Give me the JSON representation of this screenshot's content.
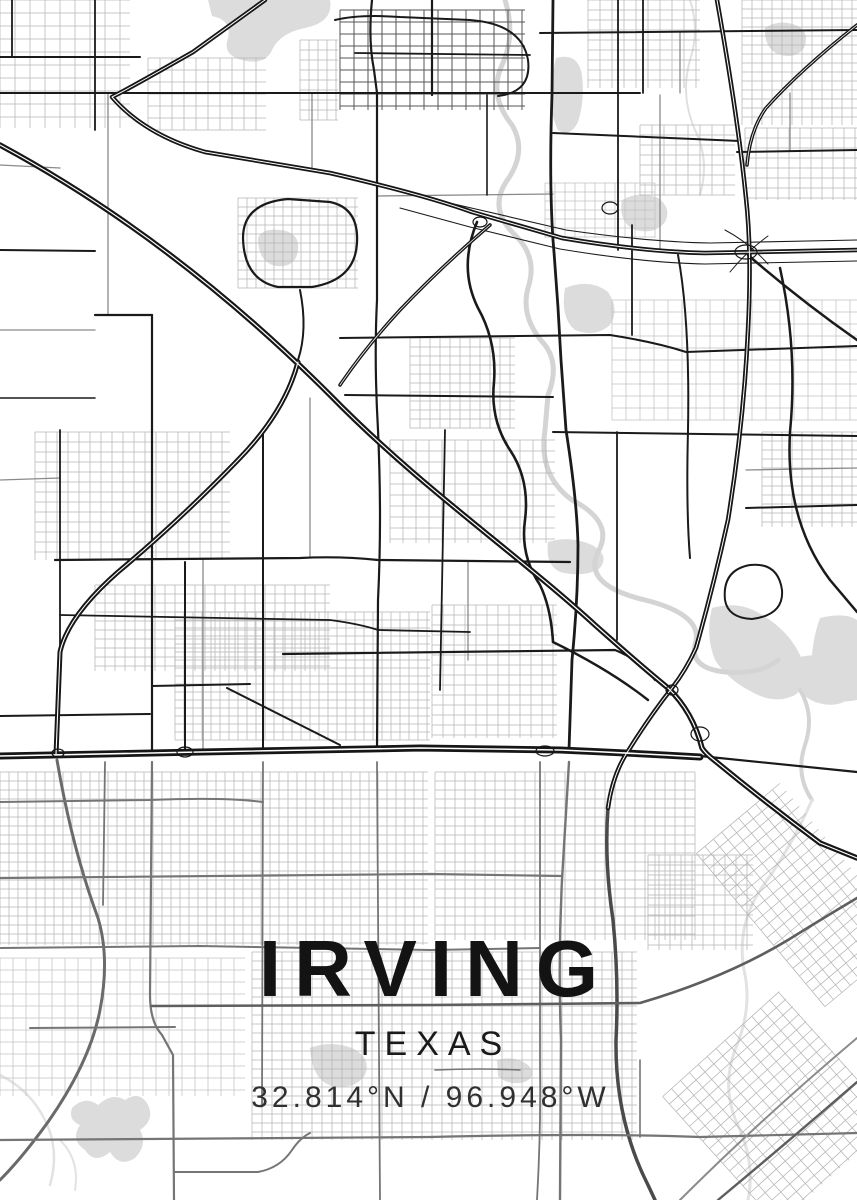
{
  "poster": {
    "city": "IRVING",
    "state": "TEXAS",
    "coordinates": "32.814°N / 96.948°W",
    "colors": {
      "background": "#ffffff",
      "title": "#131313",
      "subtitle": "#1a1a1a",
      "coords": "#303030",
      "road_major": "#1a1a1a",
      "road_medium": "#8a8a8a",
      "road_minor": "#b5b5b5",
      "road_gray": "#757575",
      "freeway": "#161616",
      "freeway_core": "#ffffff",
      "water": "#dcdcdc",
      "river": "#d4d4d4"
    },
    "map": {
      "water": [
        {
          "d": "M208,0 L330,0 Q334,22 305,28 Q280,33 272,50 Q265,66 242,60 Q222,55 228,38 Q232,20 212,16 Z"
        },
        {
          "d": "M765,28 Q780,18 798,26 Q810,34 804,48 Q795,60 778,54 Q764,48 765,28 Z"
        },
        {
          "d": "M556,58 Q578,52 582,75 Q585,100 578,122 Q570,138 558,130 Q548,110 552,85 Q553,70 556,58 Z"
        },
        {
          "d": "M622,200 Q640,190 658,198 Q672,208 665,222 Q655,235 635,230 Q618,222 622,200 Z"
        },
        {
          "d": "M258,238 Q262,228 280,230 Q300,232 298,250 Q296,268 276,266 Q258,262 258,238 Z"
        },
        {
          "d": "M565,288 Q590,278 608,292 Q620,310 610,325 Q595,338 575,330 Q560,318 565,288 Z"
        },
        {
          "d": "M548,542 Q570,535 592,545 Q610,555 600,568 Q585,578 560,572 Q545,565 548,542 Z"
        },
        {
          "d": "M712,608 Q740,600 762,615 Q788,630 800,655 Q812,682 795,695 Q775,705 752,692 Q728,680 715,660 Q705,635 712,608 Z"
        },
        {
          "d": "M795,658 Q825,650 845,665 Q860,680 852,695 Q840,710 815,702 Q798,695 795,678 Z"
        },
        {
          "d": "M820,618 Q845,612 857,620 L857,700 Q835,705 818,692 Q805,660 820,618 Z"
        },
        {
          "d": "M310,1048 Q330,1040 352,1048 Q372,1058 365,1075 Q355,1090 332,1086 Q312,1080 310,1048 Z"
        },
        {
          "d": "M497,1060 Q515,1055 528,1065 Q538,1075 525,1082 Q508,1086 498,1076 Z"
        },
        {
          "d": "M72,1108 Q85,1095 98,1105 Q112,1092 125,1100 Q140,1090 148,1105 Q155,1120 140,1130 Q148,1145 135,1158 Q120,1168 110,1152 Q95,1165 85,1150 Q70,1140 80,1125 Q68,1120 72,1108 Z"
        }
      ],
      "rivers": [
        {
          "d": "M505,0 Q516,35 502,65 Q488,95 512,125 Q528,152 506,182 Q488,210 516,236 Q538,258 528,288 Q520,318 545,345 Q560,365 548,395 L545,430",
          "w": 5
        },
        {
          "d": "M545,430 Q538,475 572,500 Q615,522 598,552 Q582,585 645,600 Q705,615 695,645 Q690,668 725,672 Q760,675 778,660",
          "w": 5
        },
        {
          "d": "M800,690 Q815,715 805,745 Q795,775 812,800",
          "w": 4
        },
        {
          "d": "M812,800 Q790,850 760,890 Q735,930 745,975 Q752,1010 735,1050 Q720,1090 740,1130 Q755,1165 748,1200",
          "w": 3,
          "c": "#e2e2e2"
        },
        {
          "d": "M690,0 Q700,30 690,60 Q680,95 695,130 Q710,160 700,195",
          "w": 2,
          "c": "#e0e0e0"
        },
        {
          "d": "M0,1075 Q30,1090 45,1120 Q60,1150 50,1185",
          "w": 2.5,
          "c": "#e2e2e2"
        },
        {
          "d": "M60,1140 Q80,1160 75,1190",
          "w": 2,
          "c": "#e2e2e2"
        }
      ],
      "grids": [
        {
          "x": 0,
          "y": 0,
          "w": 130,
          "h": 128,
          "gx": 15,
          "gy": 13
        },
        {
          "x": 148,
          "y": 58,
          "w": 118,
          "h": 72,
          "gx": 12,
          "gy": 12
        },
        {
          "x": 300,
          "y": 40,
          "w": 38,
          "h": 80,
          "gx": 9,
          "gy": 10
        },
        {
          "x": 340,
          "y": 10,
          "w": 185,
          "h": 100,
          "gx": 14,
          "gy": 12,
          "c": "#555555",
          "lw": 1
        },
        {
          "x": 588,
          "y": 0,
          "w": 112,
          "h": 88,
          "gx": 12,
          "gy": 10
        },
        {
          "x": 742,
          "y": 0,
          "w": 115,
          "h": 125,
          "gx": 10,
          "gy": 9
        },
        {
          "x": 745,
          "y": 128,
          "w": 112,
          "h": 72,
          "gx": 11,
          "gy": 10
        },
        {
          "x": 640,
          "y": 125,
          "w": 95,
          "h": 70,
          "gx": 12,
          "gy": 10
        },
        {
          "x": 545,
          "y": 183,
          "w": 110,
          "h": 55,
          "gx": 10,
          "gy": 9,
          "c": "#c0c0c0"
        },
        {
          "x": 238,
          "y": 198,
          "w": 120,
          "h": 90,
          "gx": 9,
          "gy": 9
        },
        {
          "x": 612,
          "y": 300,
          "w": 245,
          "h": 120,
          "gx": 14,
          "gy": 12,
          "c": "#c0c0c0"
        },
        {
          "x": 410,
          "y": 338,
          "w": 105,
          "h": 90,
          "gx": 10,
          "gy": 9
        },
        {
          "x": 35,
          "y": 432,
          "w": 195,
          "h": 128,
          "gx": 11,
          "gy": 10
        },
        {
          "x": 95,
          "y": 585,
          "w": 235,
          "h": 86,
          "gx": 10,
          "gy": 9
        },
        {
          "x": 175,
          "y": 612,
          "w": 255,
          "h": 128,
          "gx": 9,
          "gy": 8
        },
        {
          "x": 390,
          "y": 440,
          "w": 165,
          "h": 103,
          "gx": 13,
          "gy": 11
        },
        {
          "x": 432,
          "y": 605,
          "w": 125,
          "h": 133,
          "gx": 11,
          "gy": 10
        },
        {
          "x": 762,
          "y": 432,
          "w": 95,
          "h": 95,
          "gx": 10,
          "gy": 9
        },
        {
          "x": 0,
          "y": 772,
          "w": 428,
          "h": 173,
          "gx": 9,
          "gy": 9
        },
        {
          "x": 435,
          "y": 772,
          "w": 260,
          "h": 168,
          "gx": 10,
          "gy": 9
        },
        {
          "x": 0,
          "y": 958,
          "w": 245,
          "h": 138,
          "gx": 13,
          "gy": 12,
          "c": "#c2c2c2"
        },
        {
          "x": 252,
          "y": 952,
          "w": 385,
          "h": 188,
          "gx": 10,
          "gy": 9
        },
        {
          "x": 648,
          "y": 855,
          "w": 105,
          "h": 95,
          "gx": 11,
          "gy": 10
        },
        {
          "x": 700,
          "y": 1022,
          "w": 157,
          "h": 172,
          "gx": 12,
          "gy": 10,
          "rot": -42
        },
        {
          "x": 748,
          "y": 795,
          "w": 109,
          "h": 200,
          "gx": 11,
          "gy": 10,
          "rot": -40
        }
      ],
      "mediums": [
        {
          "d": "M108,93 L108,315"
        },
        {
          "d": "M310,398 L310,558"
        },
        {
          "d": "M312,93 L312,170"
        },
        {
          "d": "M660,95 L660,250"
        },
        {
          "d": "M0,330 L95,330"
        },
        {
          "d": "M377,196 L553,194"
        },
        {
          "d": "M746,470 L857,468"
        },
        {
          "d": "M790,93 L790,150"
        },
        {
          "d": "M680,33 L680,93"
        },
        {
          "d": "M0,165 L60,168"
        },
        {
          "d": "M468,562 L468,660"
        },
        {
          "d": "M203,560 L203,752"
        },
        {
          "d": "M0,480 L60,478"
        }
      ],
      "grays": [
        {
          "d": "M608,808 Q604,860 613,920 Q619,980 616,1040 Q615,1120 648,1185 L655,1200",
          "w": 3.5,
          "c": "#4a4a4a"
        },
        {
          "d": "M57,760 Q72,848 98,918 Q110,958 100,1010 Q90,1062 48,1122 Q22,1158 0,1180",
          "w": 3,
          "c": "#6a6a6a"
        },
        {
          "d": "M569,762 L562,880 Q558,960 561,1040 L560,1200",
          "w": 2.4
        },
        {
          "d": "M540,762 L540,1065 Q541,1130 537,1200",
          "w": 1.8
        },
        {
          "d": "M377,762 L380,1200",
          "w": 1.8
        },
        {
          "d": "M263,762 L262,1105",
          "w": 1.8
        },
        {
          "d": "M152,762 L150,995 Q150,1022 162,1035 L173,1055 L174,1200",
          "w": 2.2
        },
        {
          "d": "M105,762 L103,905",
          "w": 1.8
        },
        {
          "d": "M0,802 L150,800 Q225,797 263,802",
          "w": 2
        },
        {
          "d": "M0,878 L430,874 L562,876",
          "w": 2.2
        },
        {
          "d": "M0,948 L200,946 L430,950 L540,948",
          "w": 2
        },
        {
          "d": "M152,1006 L430,1005 L640,1003 Q725,978 788,940 Q825,917 857,898",
          "w": 2.6,
          "c": "#5e5e5e"
        },
        {
          "d": "M30,1028 L175,1027",
          "w": 2
        },
        {
          "d": "M0,1140 L430,1137 Q600,1133 700,1137 L857,1133",
          "w": 2.2
        },
        {
          "d": "M174,1172 L258,1172 Q280,1168 292,1150 Q300,1138 310,1133",
          "w": 2
        },
        {
          "d": "M680,1200 Q760,1120 857,1038",
          "w": 2,
          "c": "#8a8a8a"
        },
        {
          "d": "M718,1200 Q790,1140 857,1082",
          "w": 2.4,
          "c": "#5e5e5e"
        },
        {
          "d": "M640,1060 L640,1137",
          "w": 1.6
        },
        {
          "d": "M435,1070 Q480,1068 520,1070",
          "w": 1.6
        }
      ],
      "majors": [
        {
          "d": "M0,93 L640,93",
          "w": 2
        },
        {
          "d": "M540,33 L857,30",
          "w": 2
        },
        {
          "d": "M553,0 L552,95 Q549,180 553,240 Q558,300 561,360 L566,430 Q577,500 578,545 Q578,600 572,660 L569,750",
          "w": 2.8
        },
        {
          "d": "M372,0 Q368,40 374,70 L377,93 L377,300 Q374,360 378,430 Q382,520 378,600 L377,750",
          "w": 2.2
        },
        {
          "d": "M263,430 L263,750",
          "w": 2
        },
        {
          "d": "M152,315 L152,750",
          "w": 2.2
        },
        {
          "d": "M95,315 L152,315",
          "w": 2.2
        },
        {
          "d": "M0,250 L95,251",
          "w": 2
        },
        {
          "d": "M0,57 L140,57",
          "w": 2
        },
        {
          "d": "M12,0 L12,57",
          "w": 1.8
        },
        {
          "d": "M95,0 L95,130",
          "w": 1.8
        },
        {
          "d": "M643,0 L643,93",
          "w": 1.8
        },
        {
          "d": "M618,0 L618,250",
          "w": 1.8
        },
        {
          "d": "M553,133 L740,141",
          "w": 2
        },
        {
          "d": "M737,152 L857,150",
          "w": 2
        },
        {
          "d": "M60,430 L60,650",
          "w": 1.8
        },
        {
          "d": "M0,398 L95,398",
          "w": 1.6
        },
        {
          "d": "M55,560 L300,558 Q340,556 378,560 L570,562",
          "w": 2.2
        },
        {
          "d": "M60,615 L330,620 Q360,624 378,630 L470,632",
          "w": 1.8
        },
        {
          "d": "M152,686 L250,684",
          "w": 2
        },
        {
          "d": "M283,654 L615,650 Q640,660 655,680",
          "w": 2.2
        },
        {
          "d": "M227,688 Q280,715 340,745",
          "w": 2
        },
        {
          "d": "M0,716 L150,714",
          "w": 2
        },
        {
          "d": "M553,432 L857,436",
          "w": 2
        },
        {
          "d": "M746,508 L857,505",
          "w": 2
        },
        {
          "d": "M243,238 Q243,203 288,199 L330,202 Q359,208 357,243 Q355,280 312,287 L278,287 Q244,280 243,238 Z",
          "w": 2.2
        },
        {
          "d": "M300,290 Q308,330 298,360",
          "w": 2
        },
        {
          "d": "M345,395 L553,397",
          "w": 2
        },
        {
          "d": "M477,222 Q458,268 478,308 Q497,342 494,382 Q490,420 510,450 Q530,480 525,520 Q520,555 540,585 Q551,608 553,642",
          "w": 2.6
        },
        {
          "d": "M553,642 Q610,670 648,700",
          "w": 2.4
        },
        {
          "d": "M725,600 Q722,570 750,565 Q778,562 782,590 Q784,615 752,619 Q728,618 725,600 Z",
          "w": 2
        },
        {
          "d": "M617,432 L617,640",
          "w": 1.8
        },
        {
          "d": "M700,756 L857,772",
          "w": 2.2
        },
        {
          "d": "M445,430 L440,690",
          "w": 1.8
        },
        {
          "d": "M487,95 L487,195",
          "w": 1.6
        },
        {
          "d": "M432,0 L432,95",
          "w": 2.2
        },
        {
          "d": "M335,20 Q360,14 400,17 L470,20 Q522,24 528,60 Q532,92 498,96",
          "w": 2
        },
        {
          "d": "M355,53 L530,55",
          "w": 1.8
        },
        {
          "d": "M340,338 L610,335 Q655,342 686,352 L857,346",
          "w": 2
        },
        {
          "d": "M632,225 L632,335",
          "w": 1.8
        },
        {
          "d": "M678,255 Q690,320 688,430 Q686,510 690,558",
          "w": 2
        },
        {
          "d": "M185,562 L185,752",
          "w": 2
        },
        {
          "d": "M400,208 L470,227 L560,249 Q645,263 705,264 L857,261",
          "w": 1.1
        },
        {
          "d": "M406,193 L480,210 L566,230 Q650,242 710,243 L857,240",
          "w": 1.1
        },
        {
          "d": "M725,230 Q748,242 768,264",
          "w": 1
        },
        {
          "d": "M768,236 Q746,252 730,272",
          "w": 1
        },
        {
          "d": "M748,255 Q800,300 857,340",
          "w": 2.5
        },
        {
          "d": "M780,268 Q798,350 790,432 Q785,520 830,580 L857,612",
          "w": 2.5
        }
      ],
      "freeways": [
        {
          "d": "M0,145 C130,215 240,305 330,395 C420,487 515,552 595,625 Q640,665 668,688 Q693,712 702,748 Q706,754 714,760 Q765,802 820,843 L857,858",
          "w": 5.5
        },
        {
          "d": "M298,362 Q285,412 238,460 Q178,522 118,572 Q68,616 60,652 L56,755",
          "w": 5
        },
        {
          "d": "M265,0 L193,52 Q130,88 112,97 Q145,135 205,152 L330,173 Q425,195 472,212 L562,238 Q645,252 705,253 L857,250",
          "w": 4.5
        },
        {
          "d": "M717,0 Q738,118 746,198 Q752,252 748,330 Q744,420 728,520 Q713,588 696,648 Q686,670 672,688 Q650,716 630,748 Q613,772 608,808",
          "w": 4.5
        },
        {
          "d": "M0,756 L200,752 L420,748 L560,750 Q630,753 700,757",
          "w": 7
        },
        {
          "d": "M857,25 Q800,70 766,108 Q750,130 747,165",
          "w": 3.5
        },
        {
          "d": "M490,225 Q440,268 400,310 Q365,348 340,385",
          "w": 3.5
        }
      ],
      "ramps": [
        [
          185,
          752,
          8,
          5
        ],
        [
          58,
          753,
          6,
          4
        ],
        [
          545,
          751,
          9,
          5
        ],
        [
          700,
          734,
          9,
          7
        ],
        [
          746,
          252,
          11,
          7
        ],
        [
          610,
          208,
          8,
          6
        ],
        [
          672,
          690,
          6,
          5
        ],
        [
          480,
          222,
          7,
          5
        ]
      ]
    }
  }
}
